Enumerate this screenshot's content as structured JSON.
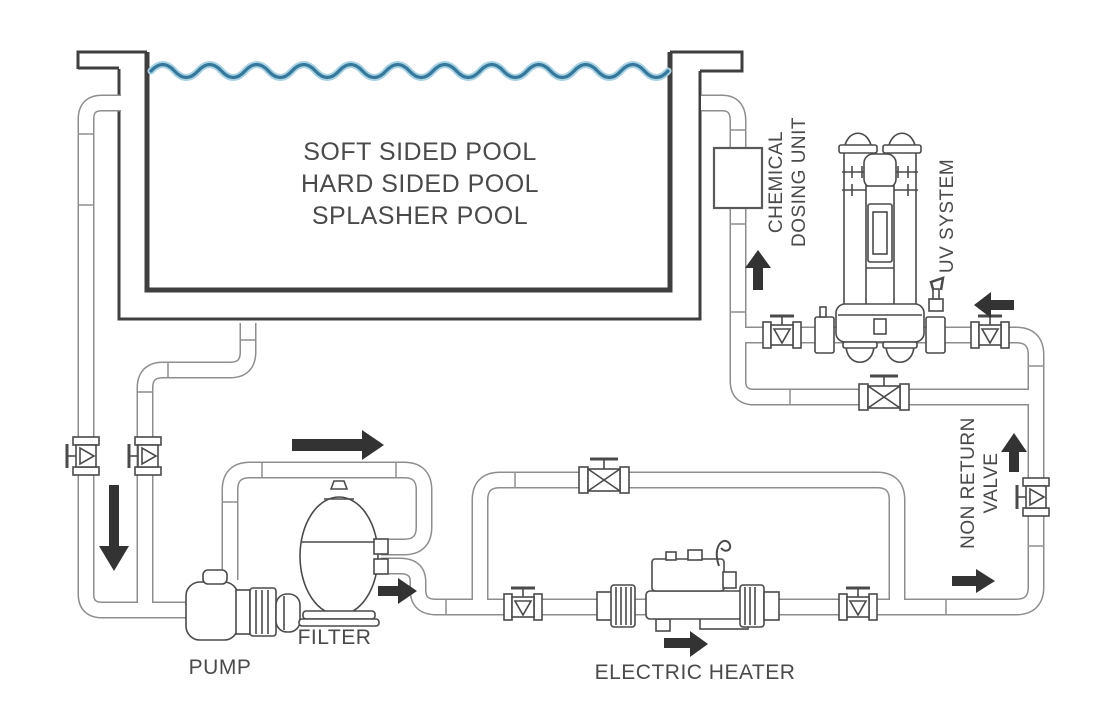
{
  "diagram": {
    "type": "pool-plumbing-schematic",
    "pool": {
      "title_lines": [
        "SOFT SIDED POOL",
        "HARD SIDED POOL",
        "SPLASHER POOL"
      ]
    },
    "labels": {
      "pump": "PUMP",
      "filter": "FILTER",
      "electric_heater": "ELECTRIC HEATER",
      "chemical_dosing_unit": {
        "line1": "CHEMICAL",
        "line2": "DOSING UNIT"
      },
      "uv_system": "UV SYSTEM",
      "non_return_valve": {
        "line1": "NON RETURN",
        "line2": "VALVE"
      }
    },
    "flow_arrows": [
      "down",
      "right-over-pump-loop",
      "right-after-filter",
      "right-under-heater",
      "right-before-riser",
      "up-non-return",
      "up-chemical",
      "left-into-uv"
    ],
    "colors": {
      "water": "#35789b",
      "water_halo": "#a9d2e3",
      "pool_wall": "#3f3f3f",
      "pipe_outline": "#8d8d8d",
      "component_line": "#4a4a4a",
      "arrow": "#333333",
      "label_text": "#4a4a4a"
    }
  }
}
